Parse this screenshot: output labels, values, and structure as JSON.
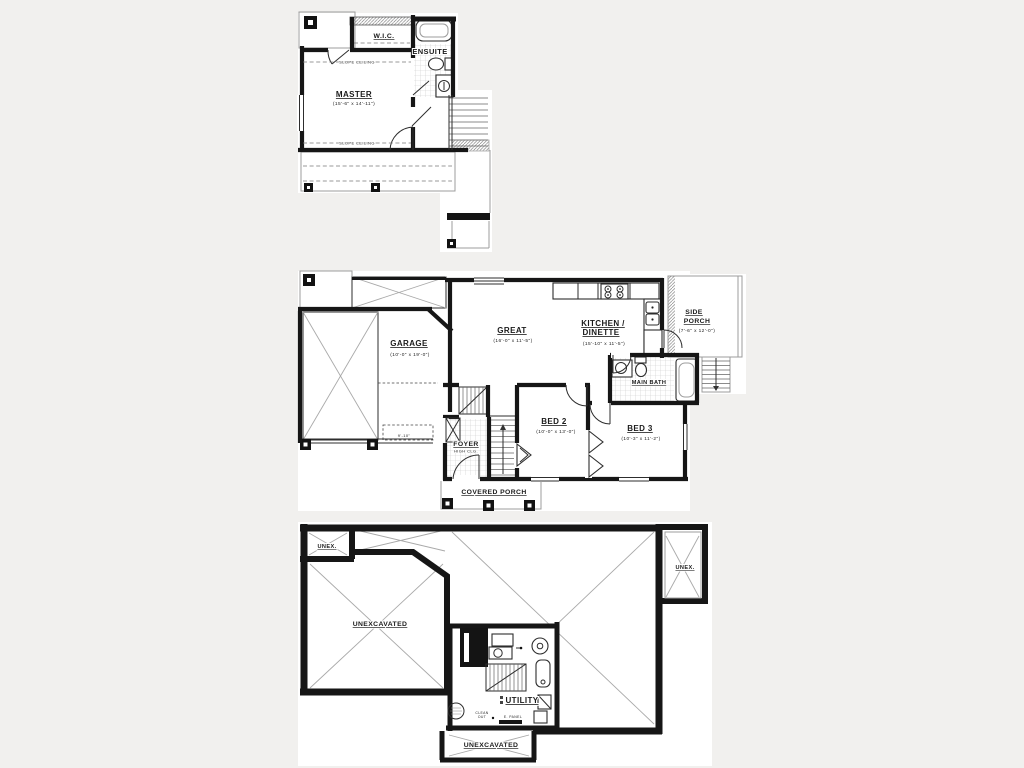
{
  "canvas": {
    "background": "#f1f0ee",
    "paper": "#ffffff",
    "wall_color": "#161616"
  },
  "upper_floor": {
    "wic_label": "W.I.C.",
    "ensuite_label": "ENSUITE",
    "master_label": "MASTER",
    "master_dims": "(15'-6\" x 14'-11\")",
    "slope_ceiling_top": "SLOPE CEILING",
    "slope_ceiling_bottom": "SLOPE CEILING"
  },
  "main_floor": {
    "garage_label": "GARAGE",
    "garage_dims": "(10'-0\" x 19'-0\")",
    "great_label": "GREAT",
    "great_dims": "(16'-0\" x 11'-5\")",
    "kitchen_label_1": "KITCHEN /",
    "kitchen_label_2": "DINETTE",
    "kitchen_dims": "(15'-10\" x 11'-5\")",
    "side_porch_label_1": "SIDE",
    "side_porch_label_2": "PORCH",
    "side_porch_dims": "(7'-6\" x 12'-0\")",
    "main_bath_label": "MAIN BATH",
    "bed2_label": "BED 2",
    "bed2_dims": "(10'-0\" x 13'-0\")",
    "bed3_label": "BED 3",
    "bed3_dims": "(10'-3\" x 11'-2\")",
    "foyer_label": "FOYER",
    "foyer_sub": "HIGH CLG.",
    "covered_porch_label": "COVERED PORCH",
    "garage_front_dim": "9'-10\""
  },
  "basement": {
    "unex_left_label": "UNEX.",
    "unex_right_label": "UNEX.",
    "unexcavated_label": "UNEXCAVATED",
    "utility_label": "UTILITY",
    "unexcavated_bottom_label": "UNEXCAVATED",
    "clean_out_label_1": "CLEAN",
    "clean_out_label_2": "OUT",
    "e_panel_label": "E. PANEL"
  }
}
